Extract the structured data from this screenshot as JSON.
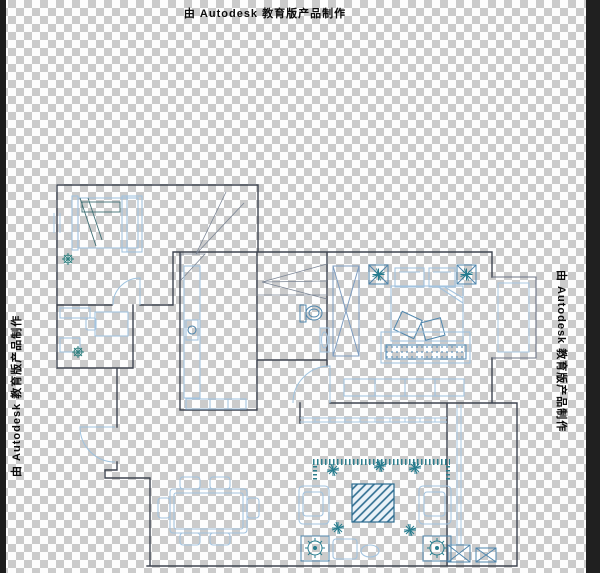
{
  "watermark": {
    "text": "由 Autodesk 教育版产品制作",
    "positions": [
      "top-center",
      "left-edge-rotated",
      "right-edge-rotated"
    ]
  },
  "canvas": {
    "checker_light": "#fdfdfd",
    "checker_dark": "#cbcbcb",
    "left_edge_strip": "#1b1b1b",
    "right_edge_strip": "#202020"
  },
  "drawing_colors": {
    "wall": "#3e4450",
    "thin_gray": "#7a8494",
    "furniture_blue": "#a3c4e0",
    "steel_blue": "#4f86ad",
    "teal": "#267c8e",
    "hatch_blue": "#2b6b8f"
  }
}
